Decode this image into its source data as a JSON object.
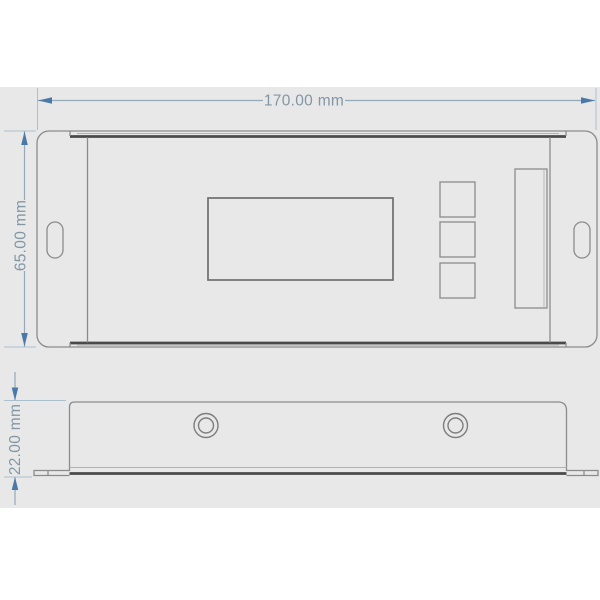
{
  "drawing": {
    "front_view": {
      "width_label": "170.00 mm",
      "height_label": "65.00 mm"
    },
    "bottom_view": {
      "depth_label": "22.00 mm"
    }
  },
  "colors": {
    "page_bg": "#ffffff",
    "canvas_bg": "#e8e8e8",
    "outline": "#8b8b8b",
    "outline_light": "#b2b2b2",
    "outline_medium": "#7d7d7d",
    "outline_strong": "#6e6e6e",
    "outline_dark": "#4a4a4a",
    "dim_ext": "#abc0cd",
    "dim_line": "#93a9b8",
    "dim_arrow": "#4a79a8",
    "dim_text": "#8297a6"
  }
}
